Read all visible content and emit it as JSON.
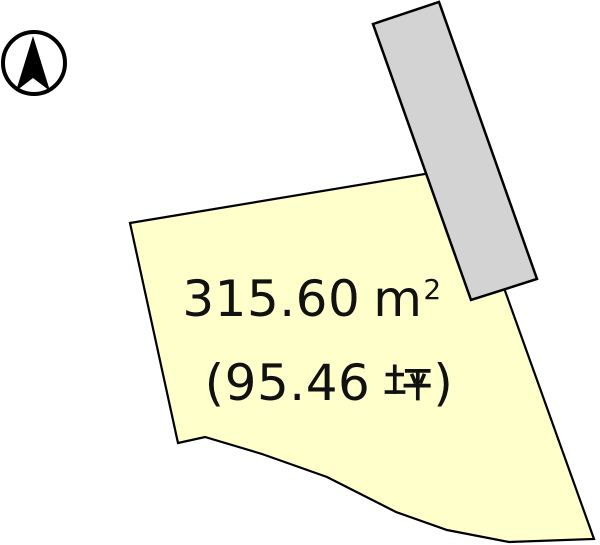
{
  "colors": {
    "background": "#ffffff",
    "plot_fill": "#ffffcc",
    "road_fill": "#d3d3d3",
    "outline": "#000000",
    "compass": "#000000",
    "text": "#111111"
  },
  "compass": {
    "icon": "north-arrow-icon"
  },
  "plot": {
    "area_m2": {
      "value": "315.60",
      "unit": "m",
      "exponent": "2",
      "display": "315.60 m²"
    },
    "area_tsubo": {
      "open": "(",
      "value": "95.46",
      "unit": "坪",
      "close": ")",
      "display": "(95.46 坪)"
    }
  }
}
